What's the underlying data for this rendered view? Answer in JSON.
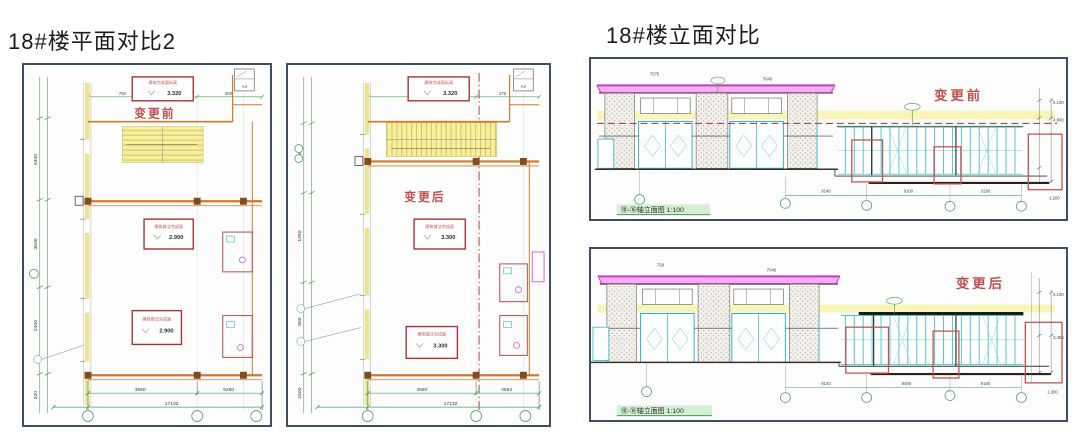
{
  "titles": {
    "plan_comparison": "18#楼平面对比2",
    "elevation_comparison": "18#楼立面对比"
  },
  "colors": {
    "panel_border": "#3e4d68",
    "wall_orange": "#cf7a2d",
    "column_brown": "#7e4e20",
    "highlight_yellow": "#f6ef9e",
    "dim_green": "#4a9d6e",
    "annotation_red": "#a83232",
    "change_label_red": "#c0504d",
    "roof_magenta": "#c83cc8",
    "roof_pink_fill": "#f3aeef",
    "window_cyan": "#35b8c8",
    "hatch_gray": "#8e9298",
    "dash_dark_red": "#a03030"
  },
  "plan_before": {
    "label": "变更前",
    "box_top": {
      "note": "建筑完成面标高",
      "value": "3.320"
    },
    "box_mid": {
      "note": "建筑做法完成面",
      "value": "2.900"
    },
    "box_bottom": {
      "note": "建筑做法完成面",
      "value": "2.900"
    },
    "dims_left": [
      "6400",
      "3600",
      "2400",
      "320"
    ],
    "dims_top": [
      "750",
      "900"
    ],
    "dims_bottom": [
      "3550",
      "5280"
    ],
    "dim_total": "17132",
    "corner_tag": "A4"
  },
  "plan_after": {
    "label": "变更后",
    "box_top": {
      "note": "建筑完成面标高",
      "value": "3.320"
    },
    "box_mid": {
      "note": "建筑做法完成面",
      "value": "3.300"
    },
    "box_bottom": {
      "note": "建筑做法完成面",
      "value": "3.300"
    },
    "dims_left": [
      "8400",
      "1450",
      "900",
      "2400"
    ],
    "dims_top": [
      "1782",
      "276"
    ],
    "dims_bottom": [
      "3550",
      "3564"
    ],
    "dim_total": "17132",
    "corner_tag": "A4"
  },
  "elev_before": {
    "label": "变更前",
    "caption": "⑩-⑯轴立面图 1:100",
    "top_labels": [
      "7075",
      "7040"
    ],
    "dims_right": [
      "5.100",
      "4.800",
      "1.200"
    ],
    "dims_bottom": [
      "9140",
      "9100",
      "9160"
    ]
  },
  "elev_after": {
    "label": "变更后",
    "caption": "⑩-⑯轴立面图 1:100",
    "top_labels": [
      "758",
      "7040"
    ],
    "dims_right": [
      "5.100",
      "3.350",
      "1.200"
    ],
    "dims_bottom": [
      "9140",
      "8490",
      "9160"
    ]
  }
}
